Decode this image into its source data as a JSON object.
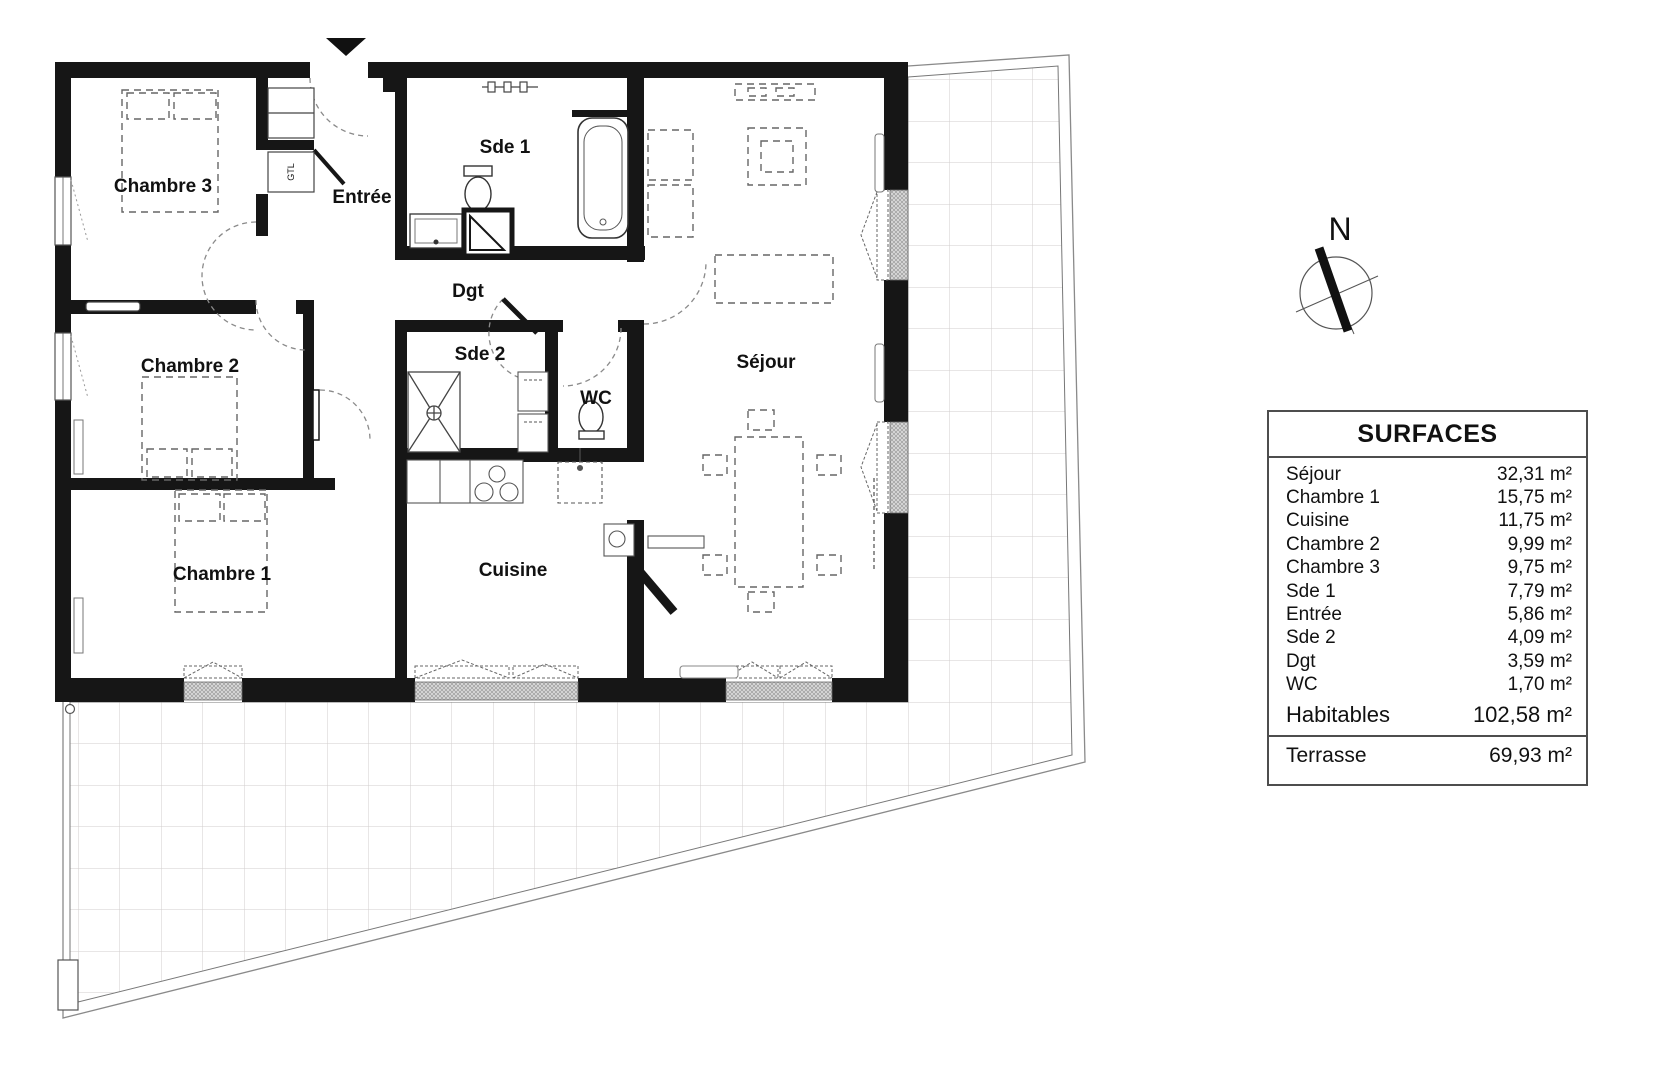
{
  "plan": {
    "rooms": [
      {
        "name": "Chambre 3"
      },
      {
        "name": "Entrée"
      },
      {
        "name": "Sde 1"
      },
      {
        "name": "Dgt"
      },
      {
        "name": "Sde 2"
      },
      {
        "name": "WC"
      },
      {
        "name": "Séjour"
      },
      {
        "name": "Cuisine"
      },
      {
        "name": "Chambre 2"
      },
      {
        "name": "Chambre 1"
      }
    ],
    "closet_label": "GTL",
    "compass": {
      "north_label": "N"
    }
  },
  "surfaces_table": {
    "title": "SURFACES",
    "rows": [
      {
        "label": "Séjour",
        "value": "32,31 m²"
      },
      {
        "label": "Chambre 1",
        "value": "15,75 m²"
      },
      {
        "label": "Cuisine",
        "value": "11,75 m²"
      },
      {
        "label": "Chambre 2",
        "value": "9,99 m²"
      },
      {
        "label": "Chambre 3",
        "value": "9,75 m²"
      },
      {
        "label": "Sde 1",
        "value": "7,79 m²"
      },
      {
        "label": "Entrée",
        "value": "5,86 m²"
      },
      {
        "label": "Sde 2",
        "value": "4,09 m²"
      },
      {
        "label": "Dgt",
        "value": "3,59 m²"
      },
      {
        "label": "WC",
        "value": "1,70 m²"
      }
    ],
    "habitables": {
      "label": "Habitables",
      "value": "102,58 m²"
    },
    "terrasse": {
      "label": "Terrasse",
      "value": "69,93 m²"
    }
  }
}
